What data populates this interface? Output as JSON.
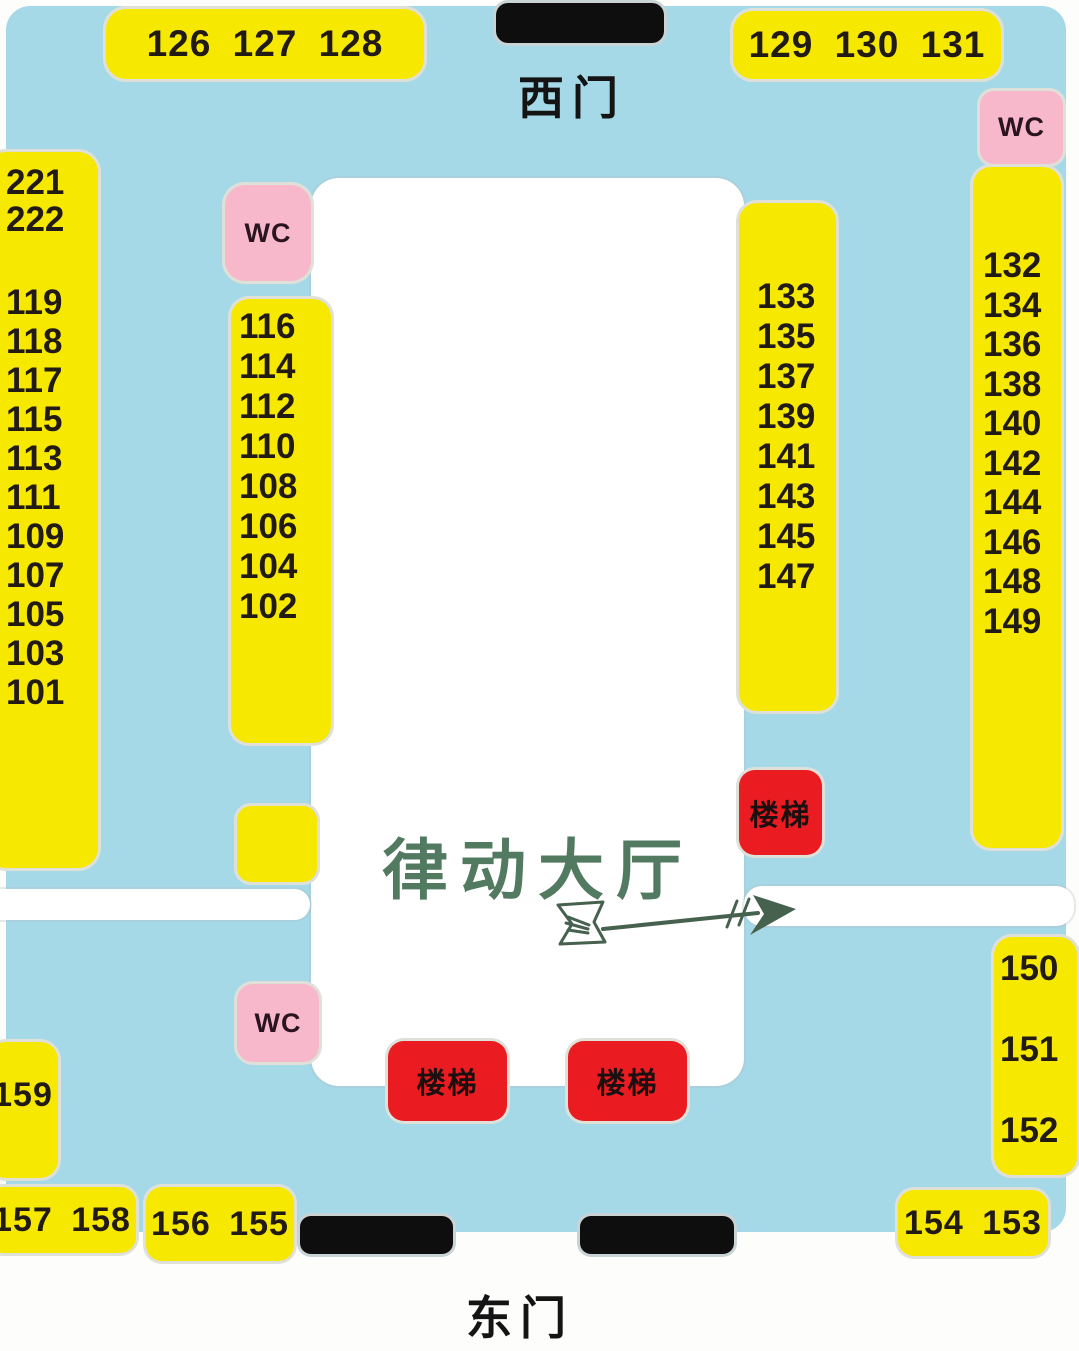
{
  "gates": {
    "west": "西门",
    "east": "东门"
  },
  "hall": {
    "label": "律动大厅"
  },
  "labels": {
    "wc": "WC",
    "stairs": "楼梯"
  },
  "booths": {
    "top_left_row": "126 127 128",
    "top_right_row": "129 130 131",
    "left_outer_upper": [
      "221",
      "222"
    ],
    "left_outer_lower": [
      "119",
      "118",
      "117",
      "115",
      "113",
      "111",
      "109",
      "107",
      "105",
      "103",
      "101"
    ],
    "left_inner": [
      "116",
      "114",
      "112",
      "110",
      "108",
      "106",
      "104",
      "102"
    ],
    "right_inner": [
      "133",
      "135",
      "137",
      "139",
      "141",
      "143",
      "145",
      "147"
    ],
    "right_outer": [
      "132",
      "134",
      "136",
      "138",
      "140",
      "142",
      "144",
      "146",
      "148",
      "149"
    ],
    "right_lower": [
      "150",
      "151",
      "152"
    ],
    "bottom_left_single": "159",
    "bottom_left_row_a": "157 158",
    "bottom_left_row_b": "156 155",
    "bottom_right_row": "154 153"
  },
  "colors": {
    "floor_blue": "#a5d9e8",
    "booth_yellow": "#f7e800",
    "wc_pink": "#f7b8cb",
    "stairs_red": "#ea1c21",
    "door_black": "#0e0e0e",
    "hall_text_green": "#527a60",
    "arrow_green": "#47614f",
    "number_black": "#211a15"
  }
}
